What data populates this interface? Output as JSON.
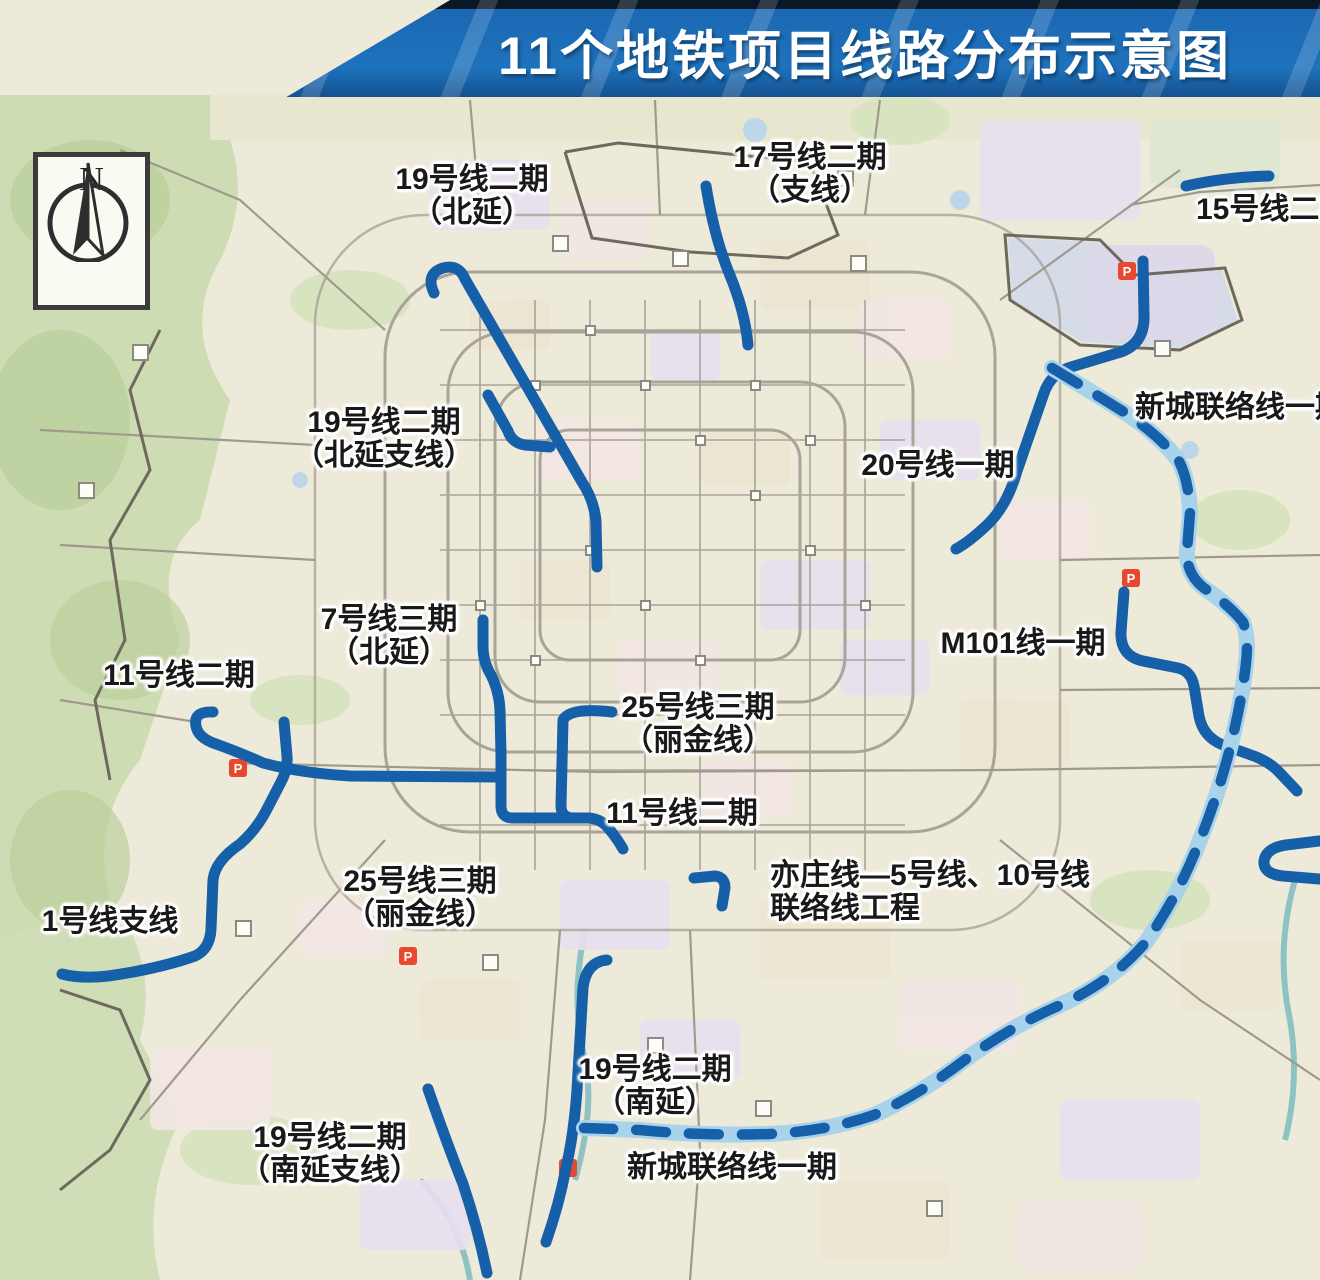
{
  "title": "11个地铁项目线路分布示意图",
  "compass": {
    "letter": "N"
  },
  "colors": {
    "banner_blue": "#1b68b3",
    "metro_line_blue": "#1560a8",
    "dashed_casing_blue": "#a9d3ea",
    "map_background": "#edead9",
    "label_text": "#191919"
  },
  "map": {
    "p_label": "P"
  },
  "labels": [
    {
      "id": "line19-north",
      "lines": {
        "0": "19号线二期",
        "1": "（北延）"
      }
    },
    {
      "id": "line17-branch",
      "lines": {
        "0": "17号线二期",
        "1": "（支线）"
      }
    },
    {
      "id": "line15-phase2",
      "lines": {
        "0": "15号线二期"
      }
    },
    {
      "id": "newtown-link-ne",
      "lines": {
        "0": "新城联络线一期"
      }
    },
    {
      "id": "line20-phase1",
      "lines": {
        "0": "20号线一期"
      }
    },
    {
      "id": "line19-north-branch",
      "lines": {
        "0": "19号线二期",
        "1": "（北延支线）"
      }
    },
    {
      "id": "line7-phase3",
      "lines": {
        "0": "7号线三期",
        "1": "（北延）"
      }
    },
    {
      "id": "line11-west",
      "lines": {
        "0": "11号线二期"
      }
    },
    {
      "id": "m101-phase1",
      "lines": {
        "0": "M101线一期"
      }
    },
    {
      "id": "line25-north",
      "lines": {
        "0": "25号线三期",
        "1": "（丽金线）"
      }
    },
    {
      "id": "line11-center",
      "lines": {
        "0": "11号线二期"
      }
    },
    {
      "id": "yizhuang-link",
      "lines": {
        "0": "亦庄线—5号线、10号线",
        "1": "联络线工程"
      }
    },
    {
      "id": "line25-south",
      "lines": {
        "0": "25号线三期",
        "1": "（丽金线）"
      }
    },
    {
      "id": "line1-branch",
      "lines": {
        "0": "1号线支线"
      }
    },
    {
      "id": "line19-south",
      "lines": {
        "0": "19号线二期",
        "1": "（南延）"
      }
    },
    {
      "id": "newtown-link-south",
      "lines": {
        "0": "新城联络线一期"
      }
    },
    {
      "id": "line19-south-branch",
      "lines": {
        "0": "19号线二期",
        "1": "（南延支线）"
      }
    }
  ],
  "metro_lines": [
    {
      "name": "19号线二期（北延）",
      "style": "solid"
    },
    {
      "name": "19号线二期（北延支线）",
      "style": "solid"
    },
    {
      "name": "17号线二期（支线）",
      "style": "solid"
    },
    {
      "name": "15号线二期",
      "style": "solid"
    },
    {
      "name": "20号线一期",
      "style": "solid"
    },
    {
      "name": "新城联络线一期",
      "style": "dashed"
    },
    {
      "name": "M101线一期",
      "style": "solid"
    },
    {
      "name": "7号线三期（北延）",
      "style": "solid"
    },
    {
      "name": "11号线二期",
      "style": "solid"
    },
    {
      "name": "1号线支线",
      "style": "solid"
    },
    {
      "name": "25号线三期（丽金线）",
      "style": "solid"
    },
    {
      "name": "19号线二期（南延）",
      "style": "solid"
    },
    {
      "name": "19号线二期（南延支线）",
      "style": "solid"
    },
    {
      "name": "亦庄线—5号线、10号线联络线工程",
      "style": "solid"
    }
  ]
}
